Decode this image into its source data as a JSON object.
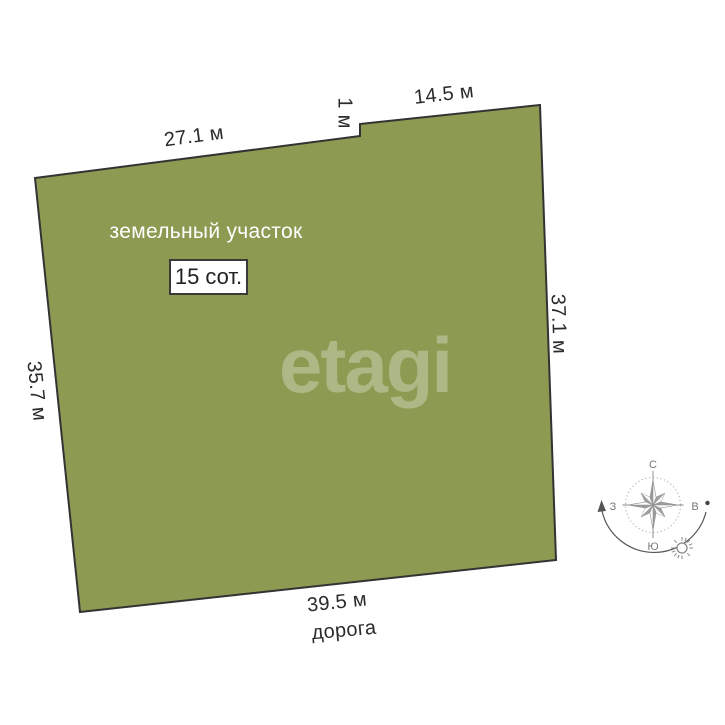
{
  "watermark": {
    "text": "etagi"
  },
  "plot": {
    "title": "земельный участок",
    "area": "15 сот.",
    "fill_color": "#8C9A52",
    "outline_color": "#333333"
  },
  "dimensions": {
    "top_left": "27.1 м",
    "notch": "1 м",
    "top_right": "14.5 м",
    "right_side": "37.1 м",
    "left_side": "35.7 м",
    "bottom": "39.5 м"
  },
  "road": {
    "label": "дорога"
  },
  "compass": {
    "north": "С",
    "south": "Ю",
    "west": "З",
    "east": "В"
  }
}
